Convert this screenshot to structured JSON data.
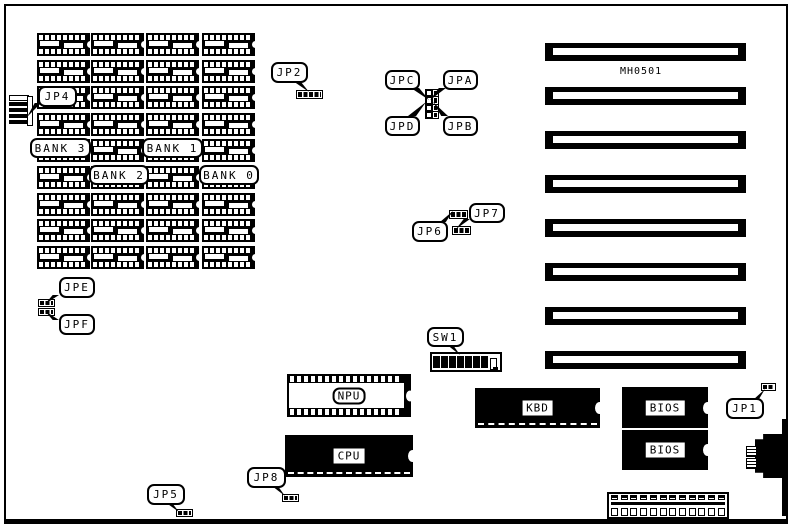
{
  "board": {
    "model_label": "MH0501"
  },
  "callouts": {
    "jp1": "JP1",
    "jp2": "JP2",
    "jp4": "JP4",
    "jp5": "JP5",
    "jp6": "JP6",
    "jp7": "JP7",
    "jp8": "JP8",
    "jpa": "JPA",
    "jpb": "JPB",
    "jpc": "JPC",
    "jpd": "JPD",
    "jpe": "JPE",
    "jpf": "JPF",
    "sw1": "SW1",
    "bank0": "BANK 0",
    "bank1": "BANK 1",
    "bank2": "BANK 2",
    "bank3": "BANK 3"
  },
  "chips": {
    "npu": "NPU",
    "cpu": "CPU",
    "kbd": "KBD",
    "bios_top": "BIOS",
    "bios_bottom": "BIOS"
  },
  "memory": {
    "columns": 4,
    "chips_per_column": 9
  },
  "expansion_slots": {
    "count": 8
  },
  "dip_switch": {
    "positions": 8,
    "on_count": 7
  },
  "power_connector": {
    "pins": 12
  },
  "colors": {
    "ink": "#000000",
    "background": "#ffffff"
  }
}
